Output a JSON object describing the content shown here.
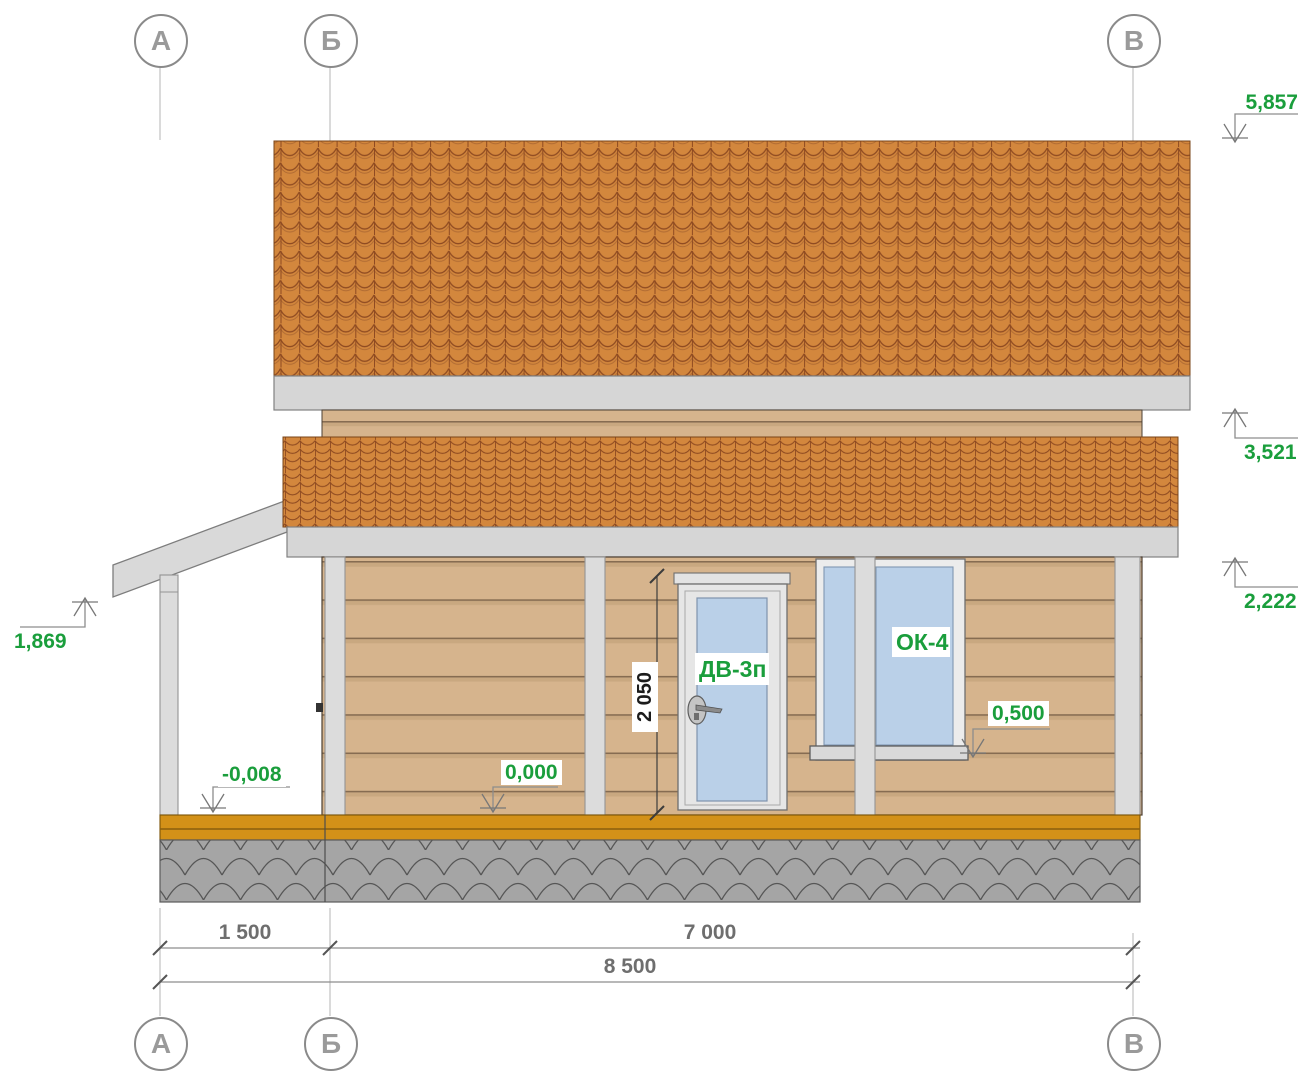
{
  "axes": {
    "a": "А",
    "b": "Б",
    "v": "В"
  },
  "elevations": {
    "e5857": "5,857",
    "e3521": "3,521",
    "e2222": "2,222",
    "e1869": "1,869",
    "e0500": "0,500",
    "e0000": "0,000",
    "em0008": "-0,008"
  },
  "dimensions": {
    "d1500": "1 500",
    "d7000": "7 000",
    "d8500": "8 500",
    "door_height": "2 050"
  },
  "tags": {
    "door": "ДВ-3п",
    "window": "ОК-4"
  },
  "colors": {
    "roof_tile": "#d3873d",
    "roof_line": "#8e4a21",
    "fascia": "#d6d6d6",
    "siding": "#d6b48d",
    "siding_seam": "#866c51",
    "trim_post": "#dcdcdc",
    "glass": "#bad0e8",
    "plinth": "#d39118",
    "foundation": "#a5a5a5",
    "elevation_green": "#1a9e3c",
    "dim_grey": "#6e6e6e"
  }
}
